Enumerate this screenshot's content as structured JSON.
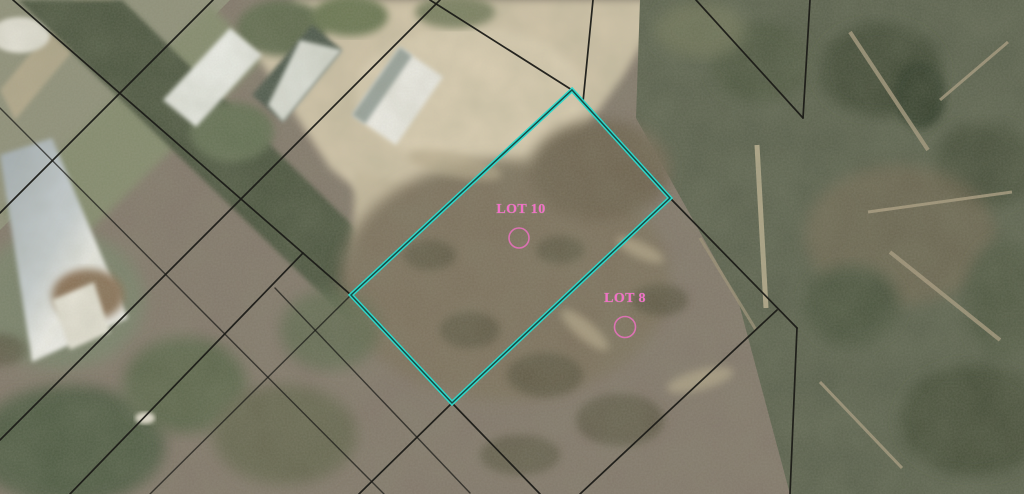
{
  "map": {
    "type": "aerial-parcel-viewer",
    "colors": {
      "highlight_cyan": "#2ed9cb",
      "label_pink": "#f170c6",
      "parcel_line_black": "#1b1b17"
    },
    "lot_labels": [
      {
        "text": "LOT 10",
        "x": 521,
        "y": 213,
        "marker": {
          "cx": 519,
          "cy": 238,
          "r": 10
        }
      },
      {
        "text": "LOT 8",
        "x": 625,
        "y": 302,
        "marker": {
          "cx": 625,
          "cy": 327,
          "r": 10.5
        }
      }
    ],
    "lot_highlight": {
      "label": "LOT 10",
      "vertices": "572,90 670,198 452,403 351,295"
    },
    "parcel_lines": {
      "segments": [
        {
          "name": "nw-se-main-through-lot10-west",
          "points": "13,0 351,295 452,403 540,494",
          "faint": false
        },
        {
          "name": "nw-se-parallel-lower-left",
          "points": "0,108 384,494",
          "faint": true
        },
        {
          "name": "nw-se-short-bottom-center",
          "points": "275,288 470,493",
          "faint": true
        },
        {
          "name": "nw-se-through-lot10-east",
          "points": "572,90 670,198 797,328",
          "faint": false
        },
        {
          "name": "nw-se-top-right",
          "points": "696,0 803,118",
          "faint": false
        },
        {
          "name": "nw-se-into-apex",
          "points": "430,0 572,90",
          "faint": false
        },
        {
          "name": "ne-sw-top-left",
          "points": "213,0 0,213",
          "faint": false
        },
        {
          "name": "ne-sw-mid-left",
          "points": "440,0 0,440",
          "faint": false
        },
        {
          "name": "ne-sw-lower-left-branch",
          "points": "303,253 70,494",
          "faint": false
        },
        {
          "name": "ne-sw-through-lot10-north",
          "points": "572,90 351,295 150,494",
          "faint": true
        },
        {
          "name": "ne-sw-through-lot10-south",
          "points": "670,198 452,403 359,494",
          "faint": false
        },
        {
          "name": "ne-sw-bottom-right-branch",
          "points": "777,310 580,494",
          "faint": false
        },
        {
          "name": "vertical-at-apex",
          "points": "593,0 583,102",
          "faint": false
        },
        {
          "name": "vertical-top-right",
          "points": "810,0 803,118",
          "faint": false
        },
        {
          "name": "vertical-bottom-right",
          "points": "797,328 790,494",
          "faint": false
        }
      ]
    }
  }
}
